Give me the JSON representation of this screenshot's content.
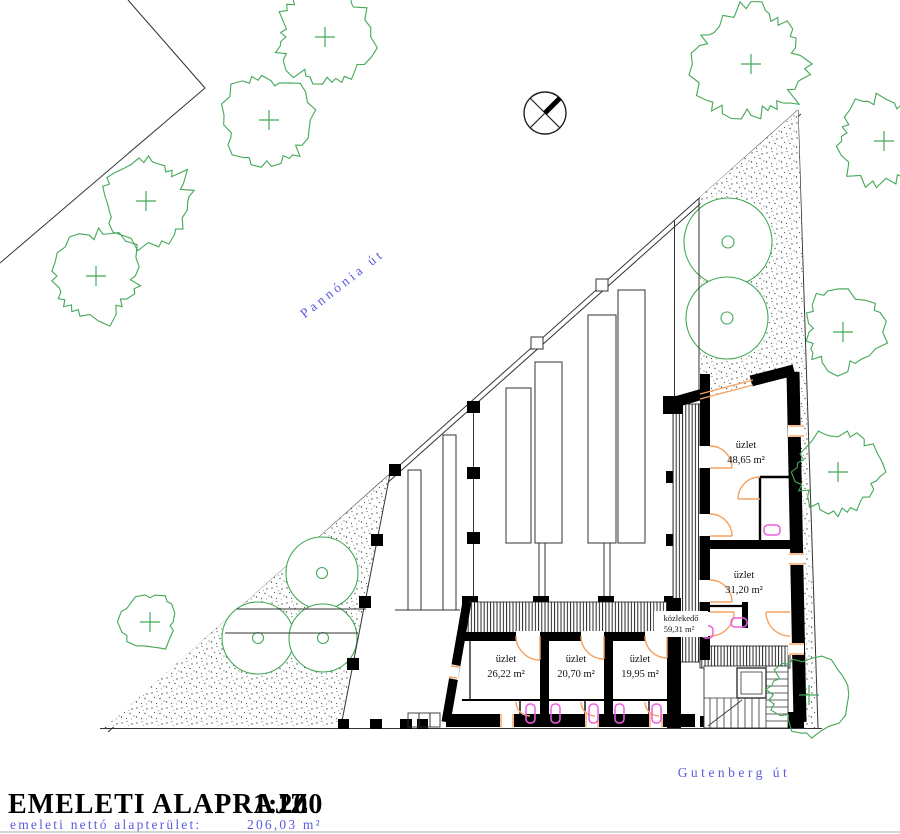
{
  "drawing": {
    "title": "EMELETI ALAPRAJZ",
    "scale": "1:200",
    "subtitle_label": "emeleti nettó alapterület:",
    "subtitle_value": "206,03 m²"
  },
  "streets": {
    "top": "Pannónia út",
    "bottom": "Gutenberg út"
  },
  "rooms": {
    "shop_large": {
      "name": "üzlet",
      "area": "48,65 m²"
    },
    "shop_mid": {
      "name": "üzlet",
      "area": "31,20 m²"
    },
    "corridor": {
      "name": "közlekedő",
      "area": "59,31 m²"
    },
    "shop_a": {
      "name": "üzlet",
      "area": "26,22 m²"
    },
    "shop_b": {
      "name": "üzlet",
      "area": "20,70 m²"
    },
    "shop_c": {
      "name": "üzlet",
      "area": "19,95 m²"
    }
  },
  "symbols": {
    "north": "north-arrow",
    "tree": "tree-canopy"
  },
  "colors": {
    "vegetation": "#43a857",
    "street_text": "#5a5ae0",
    "joinery": "#f4a464",
    "fixtures": "#ec5fe0",
    "walls": "#000000"
  }
}
